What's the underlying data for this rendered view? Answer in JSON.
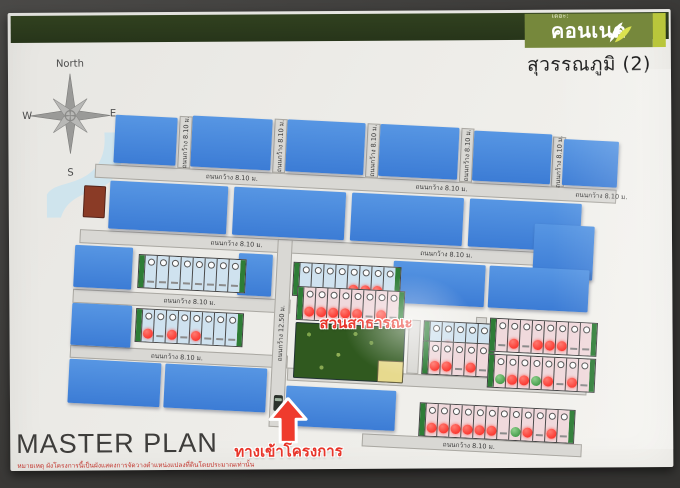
{
  "header": {
    "brand_prefix": "เดอะ:",
    "brand": "คอนเนค",
    "subtitle": "สุวรรณภูมิ (2)"
  },
  "compass": {
    "north": "North",
    "west": "W",
    "east": "E",
    "south": "S"
  },
  "annotations": {
    "park_label": "สวนสาธารณะ",
    "entrance_label": "ทางเข้าโครงการ"
  },
  "footer": {
    "title": "MASTER PLAN",
    "disclaimer": "หมายเหตุ ผังโครงการนี้เป็นผังแสดงการจัดวางตำแหน่งแปลงที่ดินโดยประมาณเท่านั้น"
  },
  "road_labels": {
    "w8": "ถนนกว้าง 8.10 ม.",
    "w12": "ถนนกว้าง 12.50 ม."
  },
  "colors": {
    "band_green": "#2d3b1c",
    "logo_olive": "#76883c",
    "logo_strip": "#b9c63b",
    "sold_cover_blue": "#3f80d8",
    "booked_dot_red": "#fb3b33",
    "available_dot_green": "#4ba04f",
    "park_green": "#30591f",
    "water_blue": "#cfe4ed",
    "utility_brown": "#8a3b26",
    "clubhouse_yellow": "#e7da8e",
    "road_gray": "#d9d8d4",
    "annotation_red": "#e8352a"
  },
  "plan": {
    "blocks": [
      {
        "x": 78,
        "y": 6,
        "w": 62,
        "h": 48,
        "t": "sold"
      },
      {
        "x": 155,
        "y": 3,
        "w": 80,
        "h": 51,
        "t": "sold"
      },
      {
        "x": 250,
        "y": 2,
        "w": 78,
        "h": 52,
        "t": "sold"
      },
      {
        "x": 343,
        "y": 2,
        "w": 79,
        "h": 52,
        "t": "sold"
      },
      {
        "x": 437,
        "y": 4,
        "w": 78,
        "h": 50,
        "t": "sold"
      },
      {
        "x": 527,
        "y": 8,
        "w": 55,
        "h": 46,
        "t": "sold"
      },
      {
        "x": 50,
        "y": 78,
        "w": 22,
        "h": 32,
        "t": "brown"
      },
      {
        "x": 76,
        "y": 72,
        "w": 118,
        "h": 48,
        "t": "sold"
      },
      {
        "x": 200,
        "y": 72,
        "w": 112,
        "h": 48,
        "t": "sold"
      },
      {
        "x": 318,
        "y": 72,
        "w": 112,
        "h": 48,
        "t": "sold"
      },
      {
        "x": 436,
        "y": 72,
        "w": 112,
        "h": 48,
        "t": "sold"
      },
      {
        "x": 502,
        "y": 94,
        "w": 60,
        "h": 54,
        "t": "sold"
      },
      {
        "x": 44,
        "y": 138,
        "w": 58,
        "h": 42,
        "t": "sold"
      },
      {
        "x": 208,
        "y": 138,
        "w": 34,
        "h": 42,
        "t": "sold"
      },
      {
        "x": 363,
        "y": 138,
        "w": 92,
        "h": 42,
        "t": "sold"
      },
      {
        "x": 459,
        "y": 138,
        "w": 100,
        "h": 42,
        "t": "sold"
      },
      {
        "x": 44,
        "y": 196,
        "w": 60,
        "h": 42,
        "t": "sold"
      },
      {
        "x": 268,
        "y": 204,
        "w": 110,
        "h": 56,
        "t": "park"
      },
      {
        "x": 352,
        "y": 238,
        "w": 26,
        "h": 22,
        "t": "yellow"
      },
      {
        "x": 44,
        "y": 252,
        "w": 92,
        "h": 44,
        "t": "sold"
      },
      {
        "x": 140,
        "y": 252,
        "w": 102,
        "h": 44,
        "t": "sold"
      },
      {
        "x": 262,
        "y": 268,
        "w": 110,
        "h": 40,
        "t": "sold"
      }
    ],
    "roads_h": [
      {
        "x": 60,
        "y": 56,
        "w": 522,
        "h": 14,
        "labels": [
          {
            "x": 110,
            "key": "w8"
          },
          {
            "x": 320,
            "key": "w8"
          },
          {
            "x": 480,
            "key": "w8"
          }
        ]
      },
      {
        "x": 48,
        "y": 122,
        "w": 460,
        "h": 14,
        "labels": [
          {
            "x": 130,
            "key": "w8"
          },
          {
            "x": 340,
            "key": "w8"
          }
        ]
      },
      {
        "x": 44,
        "y": 182,
        "w": 218,
        "h": 14,
        "labels": [
          {
            "x": 90,
            "key": "w8"
          }
        ]
      },
      {
        "x": 44,
        "y": 238,
        "w": 218,
        "h": 13,
        "labels": [
          {
            "x": 80,
            "key": "w8"
          }
        ]
      },
      {
        "x": 262,
        "y": 250,
        "w": 300,
        "h": 13,
        "labels": [
          {
            "x": 60,
            "key": "w8"
          },
          {
            "x": 210,
            "key": "w8"
          }
        ]
      },
      {
        "x": 340,
        "y": 312,
        "w": 220,
        "h": 13,
        "labels": [
          {
            "x": 80,
            "key": "w8"
          }
        ]
      }
    ],
    "roads_v": [
      {
        "x": 142,
        "y": 4,
        "w": 13,
        "h": 52,
        "key": "w8"
      },
      {
        "x": 237,
        "y": 2,
        "w": 13,
        "h": 54,
        "key": "w8"
      },
      {
        "x": 330,
        "y": 2,
        "w": 13,
        "h": 54,
        "key": "w8"
      },
      {
        "x": 424,
        "y": 2,
        "w": 13,
        "h": 54,
        "key": "w8"
      },
      {
        "x": 516,
        "y": 6,
        "w": 13,
        "h": 50,
        "key": "w8"
      },
      {
        "x": 246,
        "y": 122,
        "w": 15,
        "h": 188,
        "key": "w12"
      },
      {
        "x": 381,
        "y": 196,
        "w": 12,
        "h": 54,
        "key": null
      },
      {
        "x": 448,
        "y": 190,
        "w": 11,
        "h": 60,
        "key": null
      }
    ],
    "strips": [
      {
        "x": 108,
        "y": 144,
        "palette": "blue",
        "dots": [
          null,
          null,
          null,
          null,
          null,
          null,
          null,
          null
        ]
      },
      {
        "x": 263,
        "y": 144,
        "palette": "blue",
        "dots": [
          null,
          null,
          null,
          null,
          "red",
          "red",
          "red",
          null
        ]
      },
      {
        "x": 108,
        "y": 198,
        "palette": "blue",
        "dots": [
          "red",
          null,
          "red",
          null,
          "red",
          null,
          null,
          null
        ]
      },
      {
        "x": 268,
        "y": 168,
        "palette": "pink",
        "dots": [
          "red",
          "red",
          "red",
          "red",
          "red",
          null,
          "red",
          null
        ]
      },
      {
        "x": 396,
        "y": 196,
        "palette": "blue",
        "dots": [
          null,
          "red",
          null,
          null,
          null
        ]
      },
      {
        "x": 396,
        "y": 216,
        "palette": "pink",
        "dots": [
          "red",
          "red",
          null,
          "red",
          null
        ]
      },
      {
        "x": 462,
        "y": 190,
        "palette": "pink",
        "dots": [
          null,
          "red",
          null,
          "red",
          "red",
          "red",
          null,
          null
        ]
      },
      {
        "x": 462,
        "y": 226,
        "palette": "pink",
        "dots": [
          "green",
          "red",
          "red",
          "green",
          "red",
          null,
          "red",
          null
        ]
      },
      {
        "x": 396,
        "y": 278,
        "palette": "pink",
        "dots": [
          "red",
          "red",
          "red",
          "red",
          "red",
          "red",
          null,
          "green",
          "red",
          null,
          "red",
          null
        ]
      }
    ],
    "car": {
      "x": 250,
      "y": 278
    }
  }
}
